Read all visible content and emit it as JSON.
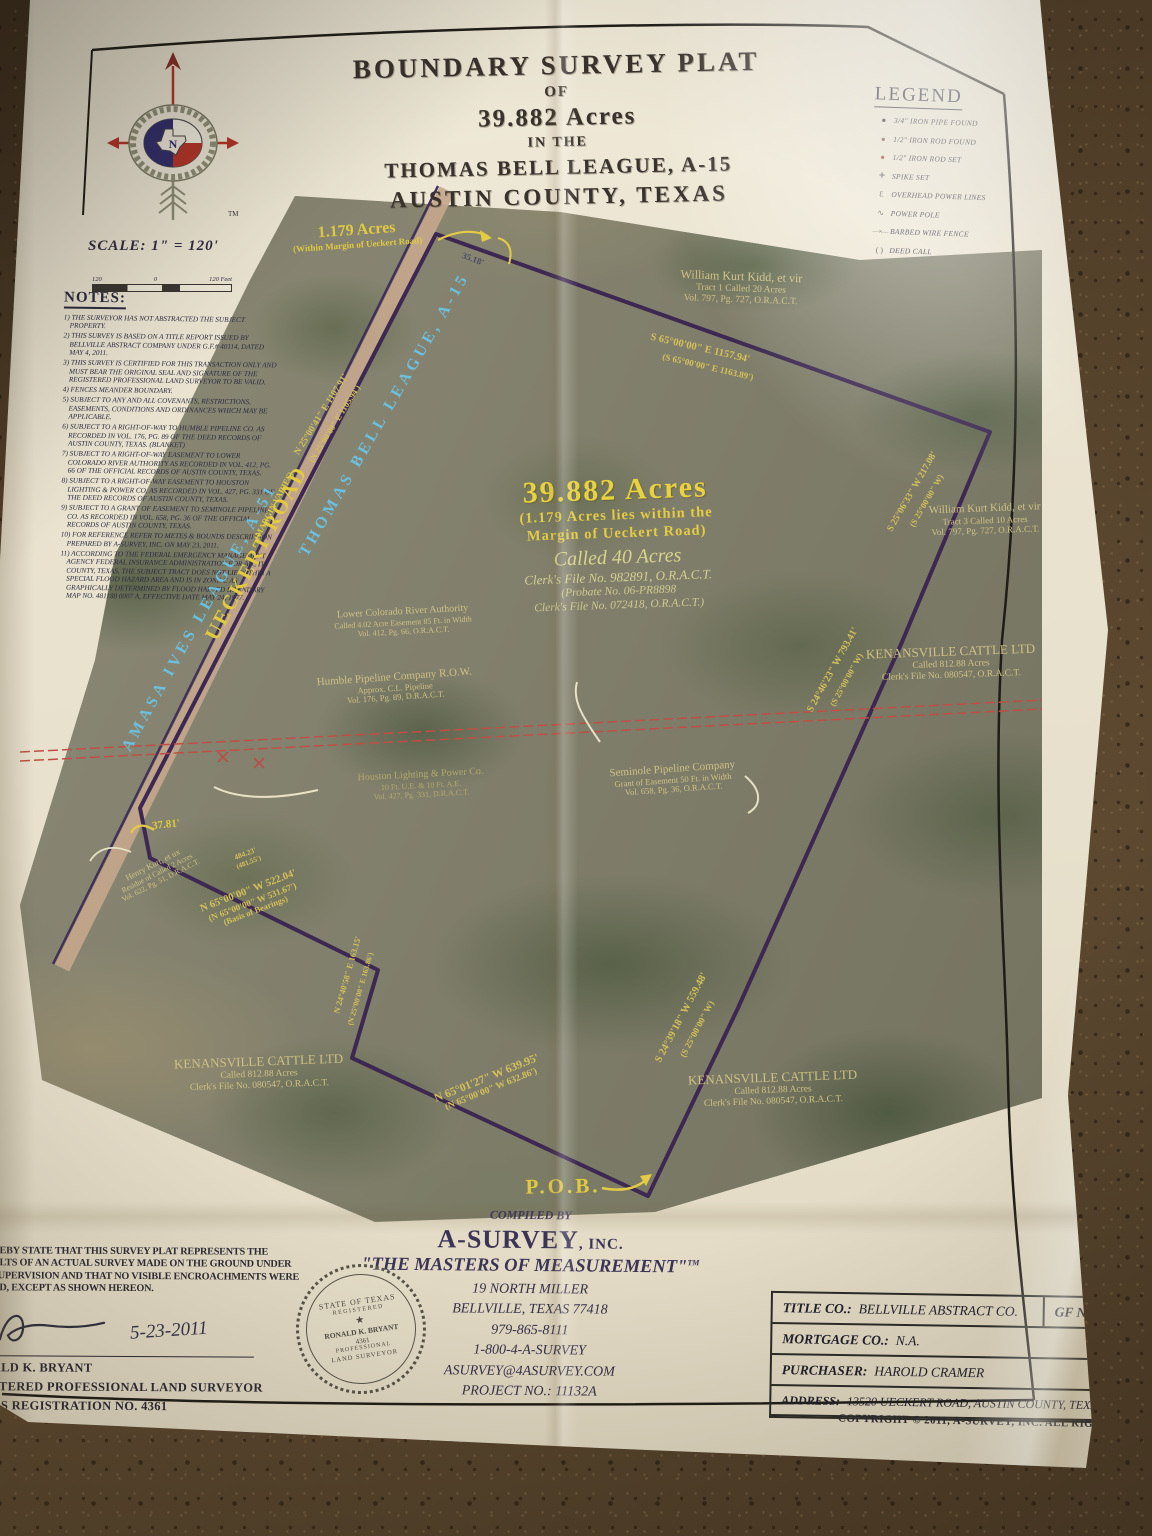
{
  "title": {
    "l1": "BOUNDARY SURVEY PLAT",
    "l2": "OF",
    "l3": "39.882 Acres",
    "l4": "IN THE",
    "l5": "THOMAS BELL LEAGUE, A-15",
    "l6": "AUSTIN COUNTY, TEXAS"
  },
  "logo": {
    "tm": "TM",
    "n": "N"
  },
  "scale": {
    "label": "SCALE: 1\" = 120'",
    "left": "120",
    "zero": "0",
    "right": "120 Feet"
  },
  "legend": {
    "title": "LEGEND",
    "items": [
      {
        "sym": "●",
        "label": "3/4\" IRON PIPE FOUND"
      },
      {
        "sym": "●",
        "label": "1/2\" IRON ROD FOUND"
      },
      {
        "sym": "●",
        "label": "1/2\" IRON ROD SET"
      },
      {
        "sym": "✚",
        "label": "SPIKE SET"
      },
      {
        "sym": "Ɛ",
        "label": "OVERHEAD POWER LINES"
      },
      {
        "sym": "∿",
        "label": "POWER POLE"
      },
      {
        "sym": "—×—",
        "label": "BARBED WIRE FENCE"
      },
      {
        "sym": "(  )",
        "label": "DEED CALL"
      }
    ]
  },
  "notes": {
    "title": "NOTES:",
    "items": [
      "1) THE SURVEYOR HAS NOT ABSTRACTED THE SUBJECT PROPERTY.",
      "2) THIS SURVEY IS BASED ON A TITLE REPORT ISSUED BY BELLVILLE ABSTRACT COMPANY UNDER G.F.# 40114, DATED MAY 4, 2011.",
      "3) THIS SURVEY IS CERTIFIED FOR THIS TRANSACTION ONLY AND MUST BEAR THE ORIGINAL SEAL AND SIGNATURE OF THE REGISTERED PROFESSIONAL LAND SURVEYOR TO BE VALID.",
      "4) FENCES MEANDER BOUNDARY.",
      "5) SUBJECT TO ANY AND ALL COVENANTS, RESTRICTIONS, EASEMENTS, CONDITIONS AND ORDINANCES WHICH MAY BE APPLICABLE.",
      "6) SUBJECT TO A RIGHT-OF-WAY TO HUMBLE PIPELINE CO. AS RECORDED IN VOL. 176, PG. 89 OF THE DEED RECORDS OF AUSTIN COUNTY, TEXAS. (BLANKET)",
      "7) SUBJECT TO A RIGHT-OF-WAY EASEMENT TO LOWER COLORADO RIVER AUTHORITY AS RECORDED IN VOL. 412, PG. 66 OF THE OFFICIAL RECORDS OF AUSTIN COUNTY, TEXAS.",
      "8) SUBJECT TO A RIGHT-OF-WAY EASEMENT TO HOUSTON LIGHTING & POWER CO. AS RECORDED IN VOL. 427, PG. 331 OF THE DEED RECORDS OF AUSTIN COUNTY, TEXAS.",
      "9) SUBJECT TO A GRANT OF EASEMENT TO SEMINOLE PIPELINE CO. AS RECORDED IN VOL. 658, PG. 36 OF THE OFFICIAL RECORDS OF AUSTIN COUNTY, TEXAS.",
      "10) FOR REFERENCE REFER TO METES & BOUNDS DESCRIPTION PREPARED BY A-SURVEY, INC. ON MAY 23, 2011.",
      "11) ACCORDING TO THE FEDERAL EMERGENCY MANAGEMENT AGENCY FEDERAL INSURANCE ADMINISTRATION FOR AUSTIN COUNTY, TEXAS, THE SUBJECT TRACT DOES NOT LIE WITHIN A SPECIAL FLOOD HAZARD AREA AND IS IN ZONE C AS GRAPHICALLY DETERMINED BY FLOOD HAZARD BOUNDARY MAP NO. 481188 0007 A, EFFECTIVE DATE MAY 24, 1977."
    ]
  },
  "map": {
    "margin_acres": {
      "l1": "1.179 Acres",
      "l2": "(Within Margin of Ueckert Road)"
    },
    "d3518": "35.18'",
    "kidd1": {
      "name": "William Kurt Kidd, et vir",
      "desc": "Tract 1 Called 20 Acres",
      "ref": "Vol. 797, Pg. 727, O.R.A.C.T."
    },
    "b_s65": {
      "main": "S 65°00'00\" E   1157.94'",
      "call": "(S 65°00'00\" E   1163.89')"
    },
    "road_bearing": {
      "main": "N 25°00'41\" E   1107.91'",
      "call": "(N 25°00'00\" E   1105.94')"
    },
    "league_left": "AMASA IVES LEAGUE, A-51",
    "road_name": "UECKERT ROAD",
    "road_margin": "(MARGIN VARIES)",
    "league_right": "THOMAS BELL LEAGUE, A-15",
    "acreage": {
      "acres": "39.882 Acres",
      "margin1": "(1.179 Acres lies within the",
      "margin2": "Margin of Ueckert Road)",
      "called": "Called 40 Acres",
      "clerk1": "Clerk's File No. 982891, O.R.A.C.T.",
      "probate": "(Probate No. 06-PR8898",
      "clerk2": "Clerk's File No. 072418, O.R.A.C.T.)"
    },
    "b_s2506": {
      "main": "S 25°06'33\" W   217.08'",
      "call": "(S 25°00'00\" W)"
    },
    "kidd3": {
      "name": "William Kurt Kidd, et vir",
      "desc": "Tract 3 Called 10 Acres",
      "ref": "Vol. 797, Pg. 727, O.R.A.C.T."
    },
    "kenansville": {
      "name": "KENANSVILLE CATTLE LTD",
      "desc": "Called 812.88 Acres",
      "ref": "Clerk's File No. 080547, O.R.A.C.T."
    },
    "b_s2446": {
      "main": "S 24°46'23\" W   793.41'",
      "call": "(S 25°00'00\" W)"
    },
    "lcra": {
      "name": "Lower Colorado River Authority",
      "desc": "Called 4.02 Acre Easement 85 Ft. in Width",
      "ref": "Vol. 412, Pg. 66, O.R.A.C.T."
    },
    "humble": {
      "name": "Humble Pipeline Company R.O.W.",
      "desc": "Approx. C.L. Pipeline",
      "ref": "Vol. 176, Pg. 89, D.R.A.C.T."
    },
    "hlp": {
      "name": "Houston Lighting & Power Co.",
      "desc": "10 Ft. U.E. & 10 Ft. A.E.",
      "ref": "Vol. 427, Pg. 331, D.R.A.C.T."
    },
    "seminole": {
      "name": "Seminole Pipeline Company",
      "desc": "Grant of Easement 50 Ft. in Width",
      "ref": "Vol. 658, Pg. 36, O.R.A.C.T."
    },
    "d3781": "37.81'",
    "kurt": {
      "name": "Henry Kurt, et ux",
      "desc": "Residue of Called 2 Acres",
      "ref": "Vol. 622, Pg. 51, D.R.A.C.T."
    },
    "d484": {
      "main": "484.23'",
      "call": "(481.55')"
    },
    "b_n65": {
      "main": "N 65°00'00\" W   522.04'",
      "call": "(N 65°00'00\" W   531.67')",
      "basis": "(Basis of Bearings)"
    },
    "b_n2440": {
      "main": "N 24°40'58\" E  163.15'",
      "call": "(N 25°00'00\" E  163.86')"
    },
    "b_n6501": {
      "main": "N 65°01'27\" W   639.95'",
      "call": "(N 65°00'00\" W   632.86')"
    },
    "b_s2439": {
      "main": "S 24°39'18\" W   559.48'",
      "call": "(S 25°00'00\" W)"
    },
    "pob": "P.O.B."
  },
  "certification": {
    "l1": "REBY STATE THAT THIS SURVEY PLAT REPRESENTS THE",
    "l2": "ULTS OF AN ACTUAL SURVEY MADE ON THE GROUND UNDER",
    "l3": "SUPERVISION AND THAT NO VISIBLE ENCROACHMENTS WERE",
    "l4": "ND, EXCEPT AS SHOWN HEREON.",
    "date": "5-23-2011",
    "name": "ALD K. BRYANT",
    "title": "STERED PROFESSIONAL LAND SURVEYOR",
    "reg": "AS REGISTRATION NO. 4361"
  },
  "seal": {
    "top": "STATE OF TEXAS",
    "reg": "REGISTERED",
    "star": "★",
    "name": "RONALD K. BRYANT",
    "num": "4361",
    "bottom1": "PROFESSIONAL",
    "bottom2": "LAND SURVEYOR"
  },
  "compiled": {
    "compiled_by": "COMPILED BY",
    "name": "A-SURVEY",
    "suffix": ", INC.",
    "tagline": "\"THE MASTERS OF MEASUREMENT\"",
    "tm": "TM",
    "addr1": "19 NORTH MILLER",
    "addr2": "BELLVILLE, TEXAS 77418",
    "phone1": "979-865-8111",
    "phone2": "1-800-4-A-SURVEY",
    "email": "ASURVEY@4ASURVEY.COM",
    "project": "PROJECT NO.: 11132A"
  },
  "title_block": {
    "title_co_label": "TITLE CO.:",
    "title_co": "BELLVILLE ABSTRACT CO.",
    "gf_label": "GF NO.:",
    "gf": "40114",
    "mortgage_label": "MORTGAGE CO.:",
    "mortgage": "N.A.",
    "purchaser_label": "PURCHASER:",
    "purchaser": "HAROLD CRAMER",
    "address_label": "ADDRESS:",
    "address": "13520 UECKERT ROAD, AUSTIN COUNTY, TEXAS"
  },
  "copyright": "COPYRIGHT © 2011, A-SURVEY, INC.  ALL RIGHTS RESERVED."
}
